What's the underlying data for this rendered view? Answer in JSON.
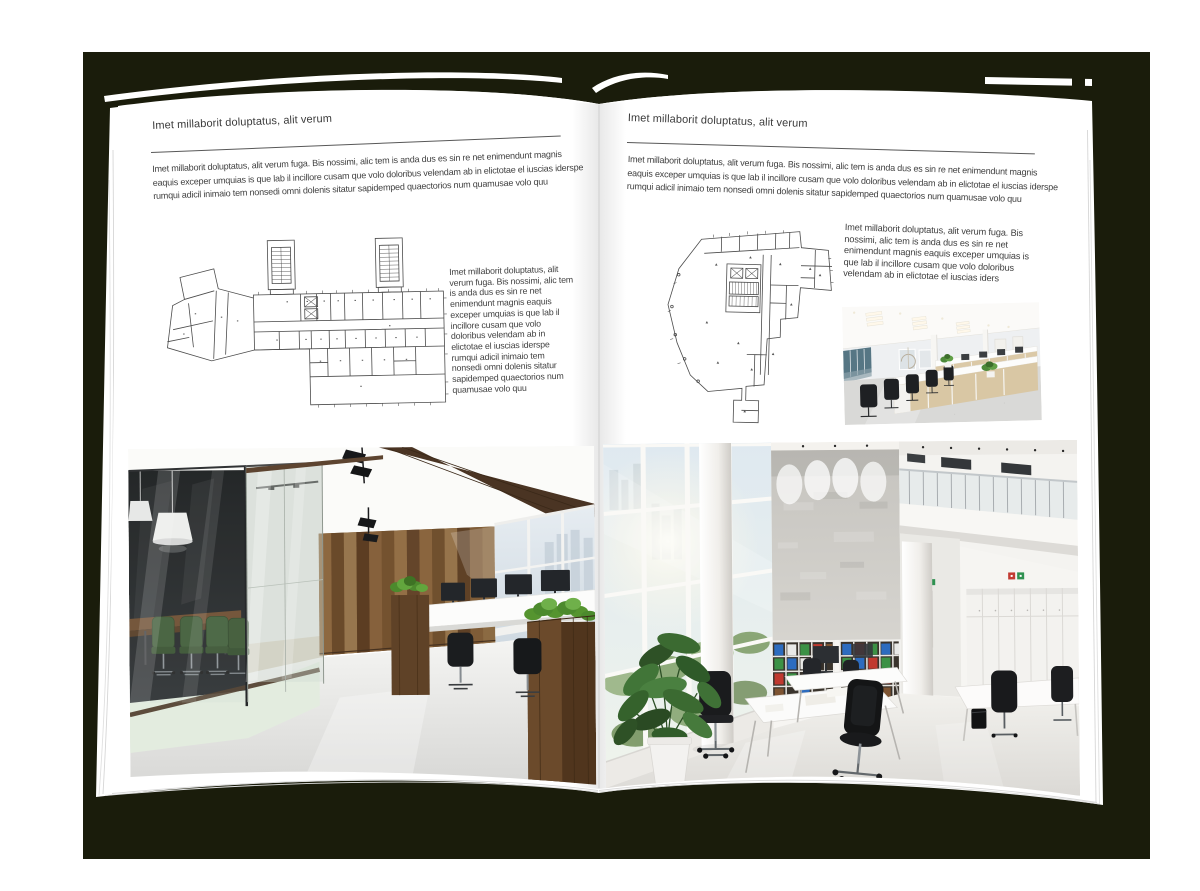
{
  "mockup": {
    "description": "Open interior-design magazine spread mockup",
    "colors": {
      "backdrop": "#1a1c0b",
      "page": "#ffffff",
      "text": "#3f3f3f",
      "rule": "#585858"
    }
  },
  "left_page": {
    "header": "Imet millaborit doluptatus, alit verum",
    "intro": "Imet millaborit doluptatus, alit verum fuga. Bis nossimi, alic tem is anda dus es sin re net enimendunt magnis eaquis exceper umquias is que lab il incillore cusam que volo doloribus velendam ab in elictotae el iuscias iderspe rumqui adicil inimaio tem nonsedi omni dolenis sitatur sapidemped quaectorios num quamusae volo quu",
    "side_text": "Imet millaborit doluptatus, alit verum fuga. Bis nossimi, alic tem is anda dus es sin re net enimendunt magnis eaquis exceper umquias is que lab il incillore cusam que volo doloribus velendam ab in elictotae el iuscias iderspe rumqui adicil inimaio tem nonsedi omni dolenis sitatur sapidemped quaectorios num quamusae volo quu",
    "floor_plan": "wide-multi-room-building-plan",
    "photo": "loft-office-glass-meeting-room-wood-wall"
  },
  "right_page": {
    "header": "Imet millaborit doluptatus, alit verum",
    "intro": "Imet millaborit doluptatus, alit verum fuga. Bis nossimi, alic tem is anda dus es sin re net enimendunt magnis eaquis exceper umquias is que lab il incillore cusam que volo doloribus velendam ab in elictotae el iuscias iderspe rumqui adicil inimaio tem nonsedi omni dolenis sitatur sapidemped quaectorios num quamusae volo quu",
    "side_text": "Imet millaborit doluptatus, alit verum fuga. Bis nossimi, alic tem is anda dus es sin re net enimendunt magnis eaquis exceper umquias is que lab il incillore cusam que volo doloribus velendam ab in elictotae el iuscias iders",
    "floor_plan": "irregular-tower-building-plan",
    "photo_small": "bright-open-plan-office-desks",
    "photo_large": "double-height-white-office-atrium"
  }
}
